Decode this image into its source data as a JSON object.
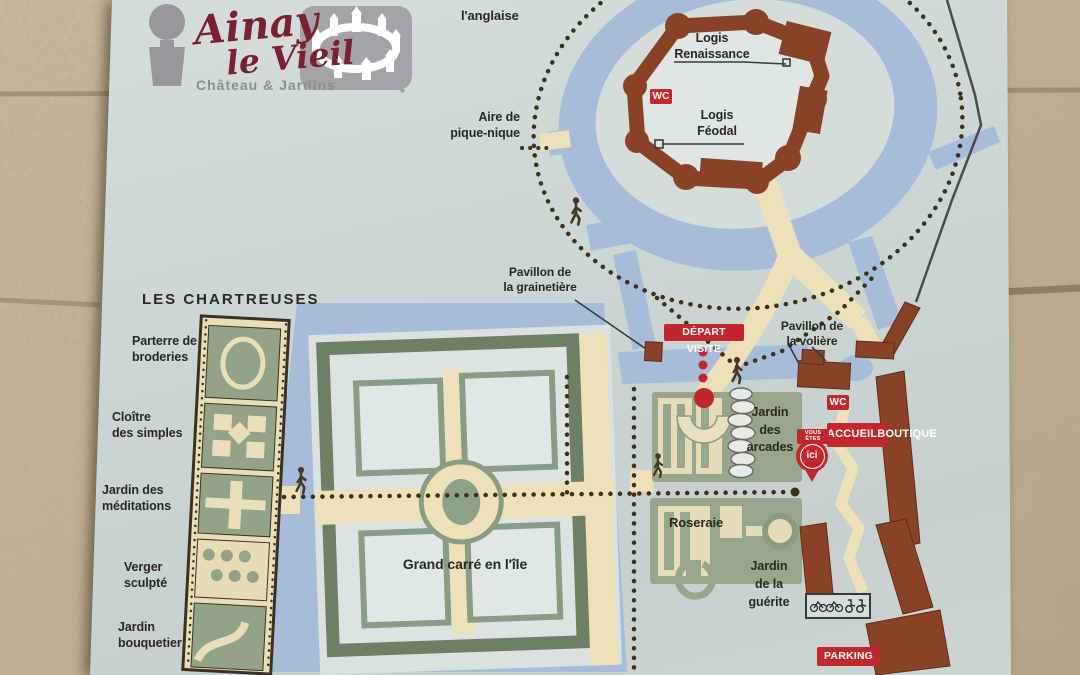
{
  "colors": {
    "sign_bg": "#cbd5d3",
    "water": "#a7bcd9",
    "castle_brown": "#8a4227",
    "path_beige": "#eee1ba",
    "garden_green": "#97a68c",
    "garden_dark_green": "#6d8066",
    "badge_red": "#c1272d",
    "dots_brown": "#3f3118",
    "stone_wall": "#c3b195",
    "logo_red": "#7b2030",
    "logo_grey": "#9a999e"
  },
  "logo": {
    "line1": "Ainay",
    "line2": "le Vieil",
    "subtitle": "Château & Jardins"
  },
  "castle": {
    "logis_renaissance_1": "Logis",
    "logis_renaissance_2": "Renaissance",
    "logis_feodal_1": "Logis",
    "logis_feodal_2": "Féodal",
    "wc": "WC"
  },
  "park": {
    "anglaise": "l'anglaise",
    "aire_1": "Aire de",
    "aire_2": "pique-nique",
    "grainetiere_1": "Pavillon de",
    "grainetiere_2": "la grainetière",
    "voliere_1": "Pavillon de",
    "voliere_2": "la volière",
    "chartreuses": "LES CHARTREUSES",
    "parterre_1": "Parterre de",
    "parterre_2": "broderies",
    "cloitre_1": "Cloître",
    "cloitre_2": "des simples",
    "meditations_1": "Jardin des",
    "meditations_2": "méditations",
    "verger_1": "Verger",
    "verger_2": "sculpté",
    "bouquetier_1": "Jardin",
    "bouquetier_2": "bouquetier",
    "grand_carre": "Grand carré en l'île",
    "arcades_1": "Jardin",
    "arcades_2": "des",
    "arcades_3": "arcades",
    "roseraie": "Roseraie",
    "guerite_1": "Jardin",
    "guerite_2": "de la",
    "guerite_3": "guérite"
  },
  "badges": {
    "depart": "DÉPART VISITE",
    "wc": "WC",
    "accueil_1": "ACCUEIL",
    "accueil_2": "BOUTIQUE",
    "parking": "PARKING",
    "ici_label": "VOUS ÊTES",
    "ici": "ici"
  }
}
